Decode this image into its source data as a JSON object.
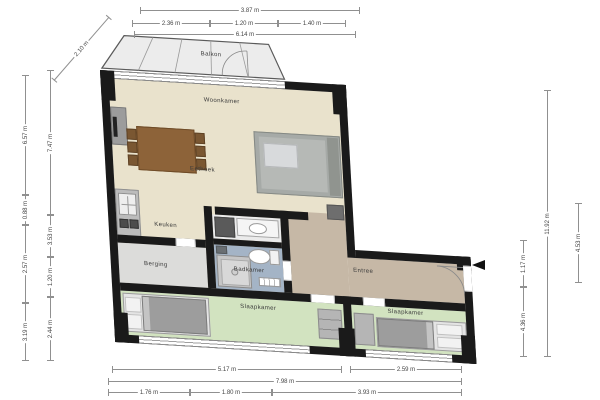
{
  "rooms": {
    "balkon": "Balkon",
    "woonkamer": "Woonkamer",
    "eethoek": "Eethoek",
    "keuken": "Keuken",
    "badkamer": "Badkamer",
    "berging": "Berging",
    "entree": "Entree",
    "slaapkamer_left": "Slaapkamer",
    "slaapkamer_right": "Slaapkamer"
  },
  "dimensions": {
    "top_total": "3.87 m",
    "top_segments": [
      "2.36 m",
      "1.20 m",
      "1.40 m"
    ],
    "top_width": "6.14 m",
    "balcony_diagonal": "2.10 m",
    "left_outer": [
      "6.57 m",
      "0.88 m",
      "2.57 m",
      "3.19 m"
    ],
    "left_inner": [
      "7.47 m",
      "3.53 m",
      "1.20 m",
      "2.44 m"
    ],
    "right_inner": [
      "1.17 m",
      "4.36 m"
    ],
    "right_total": "11.92 m",
    "right_outer": "4.53 m",
    "bottom_row1": [
      "5.17 m",
      "2.59 m"
    ],
    "bottom_total": "7.98 m",
    "bottom_row3": [
      "1.76 m",
      "1.80 m",
      "3.93 m"
    ]
  },
  "colors": {
    "wall": "#1a1a1a",
    "living_floor": "#e9e2cc",
    "bathroom_floor": "#a4b4c6",
    "bedroom_floor": "#d2e3c0",
    "entree_floor": "#c6b8a6",
    "storage_floor": "#dcdcda",
    "toilet_floor": "#ebebeb",
    "balcony_floor": "#ececec"
  },
  "icons": {
    "entrance_arrow": "entrance-direction-arrow"
  }
}
